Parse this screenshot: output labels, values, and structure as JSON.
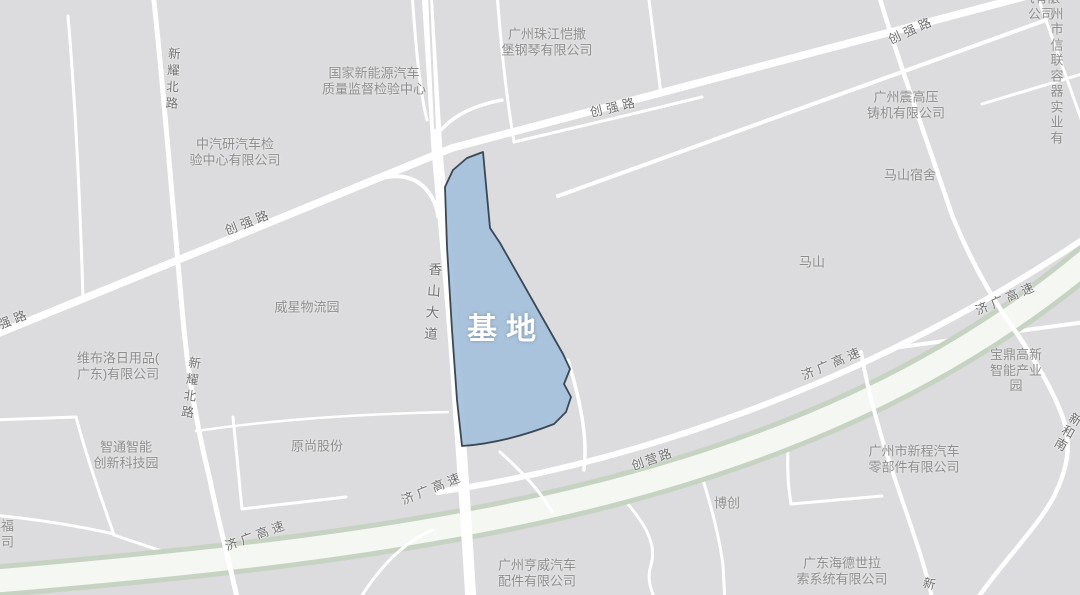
{
  "map": {
    "site_label": "基地",
    "colors": {
      "background": "#dcdbdd",
      "road": "#ffffff",
      "highway_stripe": "#c7d3c2",
      "highway_core": "#f5f7f3",
      "site_fill": "#a6c1dc",
      "site_stroke": "#3b4755",
      "place_text": "#8d8d8d",
      "road_text": "#6e6e6e",
      "site_text": "#ffffff"
    },
    "places": {
      "guojia": "国家新能源汽车\n质量监督检验中心",
      "zhujiang": "广州珠江恺撒\n堡钢琴有限公司",
      "zhongqiyan": "中汽研汽车检\n验中心有限公司",
      "qi": "气有限公司",
      "xinlian": "广州市信联\n容器实业有",
      "zhengao": "广州震高压\n铸机有限公司",
      "mashan_sushe": "马山宿舍",
      "mashan": "马山",
      "weixing": "威星物流园",
      "weibuluo": "维布洛日用品(\n广东)有限公司",
      "zhitong": "智通智能\n创新科技园",
      "yuanshang": "原尚股份",
      "baoding": "宝鼎高新\n智能产业园",
      "xincheng": "广州市新程汽车\n零部件有限公司",
      "bochuang": "博创",
      "hengwei": "广州亨威汽车\n配件有限公司",
      "haide": "广东海德世拉\n索系统有限公司",
      "yingfu": "英福\n公司"
    },
    "roads": {
      "xiangshan": "香山大道",
      "xinyao": "新耀北路",
      "chuangqiang": "创强路",
      "jiguang": "济广高速",
      "chuangying": "创营路",
      "xinhenan": "新和南",
      "xin": "新"
    }
  }
}
